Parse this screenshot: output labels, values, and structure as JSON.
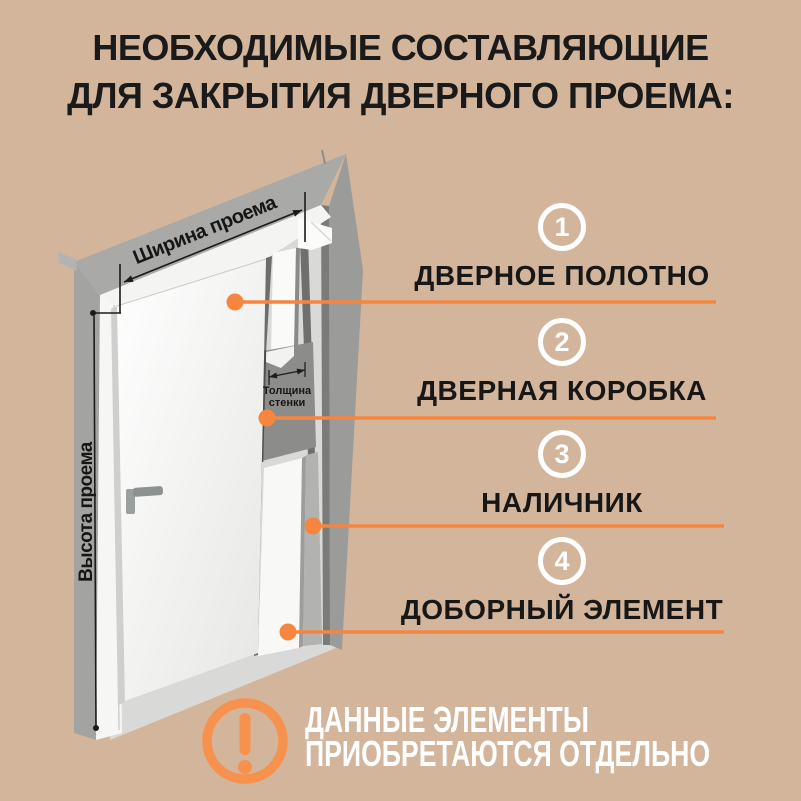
{
  "title": {
    "line1": "НЕОБХОДИМЫЕ СОСТАВЛЯЮЩИЕ",
    "line2": "ДЛЯ ЗАКРЫТИЯ ДВЕРНОГО ПРОЕМА:"
  },
  "diagram": {
    "width_label": "Ширина проема",
    "height_label": "Высота проема",
    "thickness_label": {
      "line1": "Толщина",
      "line2": "стенки"
    }
  },
  "legend": {
    "items": [
      {
        "number": "1",
        "label": "ДВЕРНОЕ ПОЛОТНО"
      },
      {
        "number": "2",
        "label": "ДВЕРНАЯ КОРОБКА"
      },
      {
        "number": "3",
        "label": "НАЛИЧНИК"
      },
      {
        "number": "4",
        "label": "ДОБОРНЫЙ ЭЛЕМЕНТ"
      }
    ]
  },
  "note": {
    "icon": "exclamation-icon",
    "line1": "ДАННЫЕ ЭЛЕМЕНТЫ",
    "line2": "ПРИОБРЕТАЮТСЯ ОТДЕЛЬНО"
  },
  "colors": {
    "background": "#d3b59c",
    "accent_orange": "#f6863f",
    "icon_orange": "#f6914e",
    "text_dark": "#1a1a1a",
    "text_light": "#ffffff",
    "wall_gray": "#a0a09e",
    "door_white": "#f7f7f5"
  }
}
